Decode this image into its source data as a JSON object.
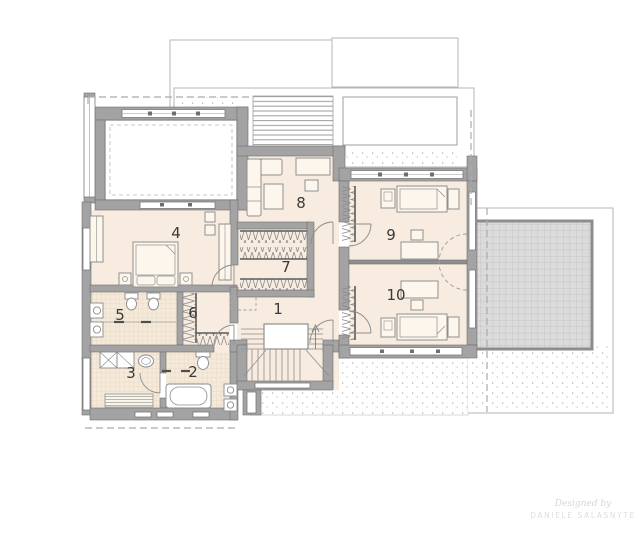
{
  "rooms": [
    {
      "number": "1"
    },
    {
      "number": "2"
    },
    {
      "number": "3"
    },
    {
      "number": "4"
    },
    {
      "number": "5"
    },
    {
      "number": "6"
    },
    {
      "number": "7"
    },
    {
      "number": "8"
    },
    {
      "number": "9"
    },
    {
      "number": "10"
    }
  ],
  "watermark": {
    "line1": "Designed by",
    "line2": "DANIELE SALASNYTE"
  },
  "colors": {
    "wall": "#a3a3a3",
    "wall_edge": "#6f6f6f",
    "floor": "#f7ecdf",
    "tile": "#f5e9d9",
    "roof_outline": "#b5b5b5",
    "dashed_line": "#ababab",
    "balcony_grid_fill": "#dbdbdb",
    "balcony_grid_line": "#bdbdbd",
    "furniture_stroke": "#8f8f8f",
    "label_text": "#3a3a3a"
  }
}
